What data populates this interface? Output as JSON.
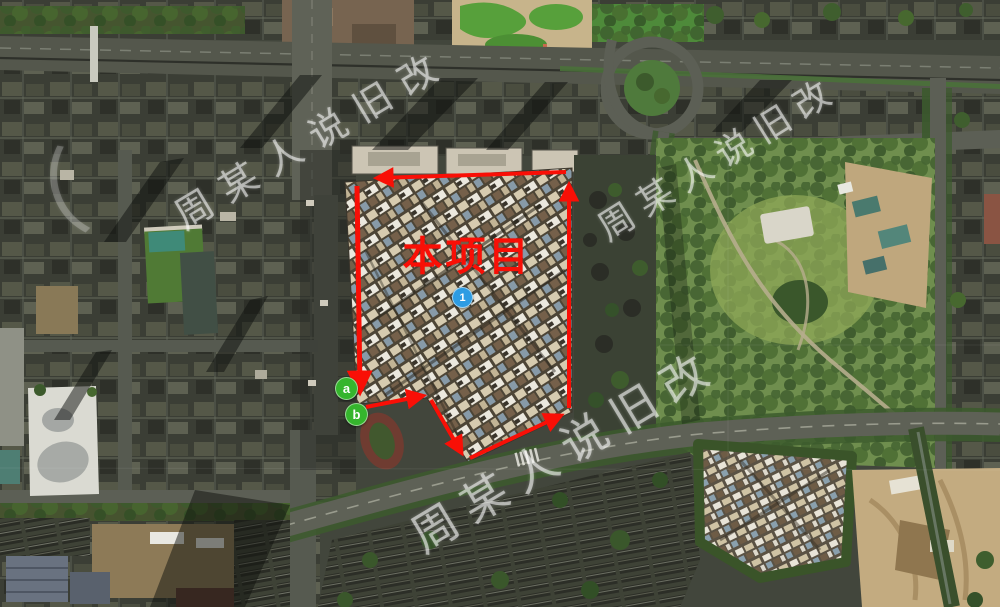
{
  "project": {
    "label": "本项目"
  },
  "watermark": {
    "text": "周某人说旧改",
    "fragment": "（"
  },
  "markers": {
    "point1": {
      "label": "1"
    },
    "a": {
      "label": "a"
    },
    "b": {
      "label": "b"
    }
  },
  "colors": {
    "annotation-red": "#f90f06",
    "marker-blue": "#2d9ce3",
    "marker-green": "#35b52d",
    "watermark-white": "rgba(255,255,255,0.55)"
  }
}
